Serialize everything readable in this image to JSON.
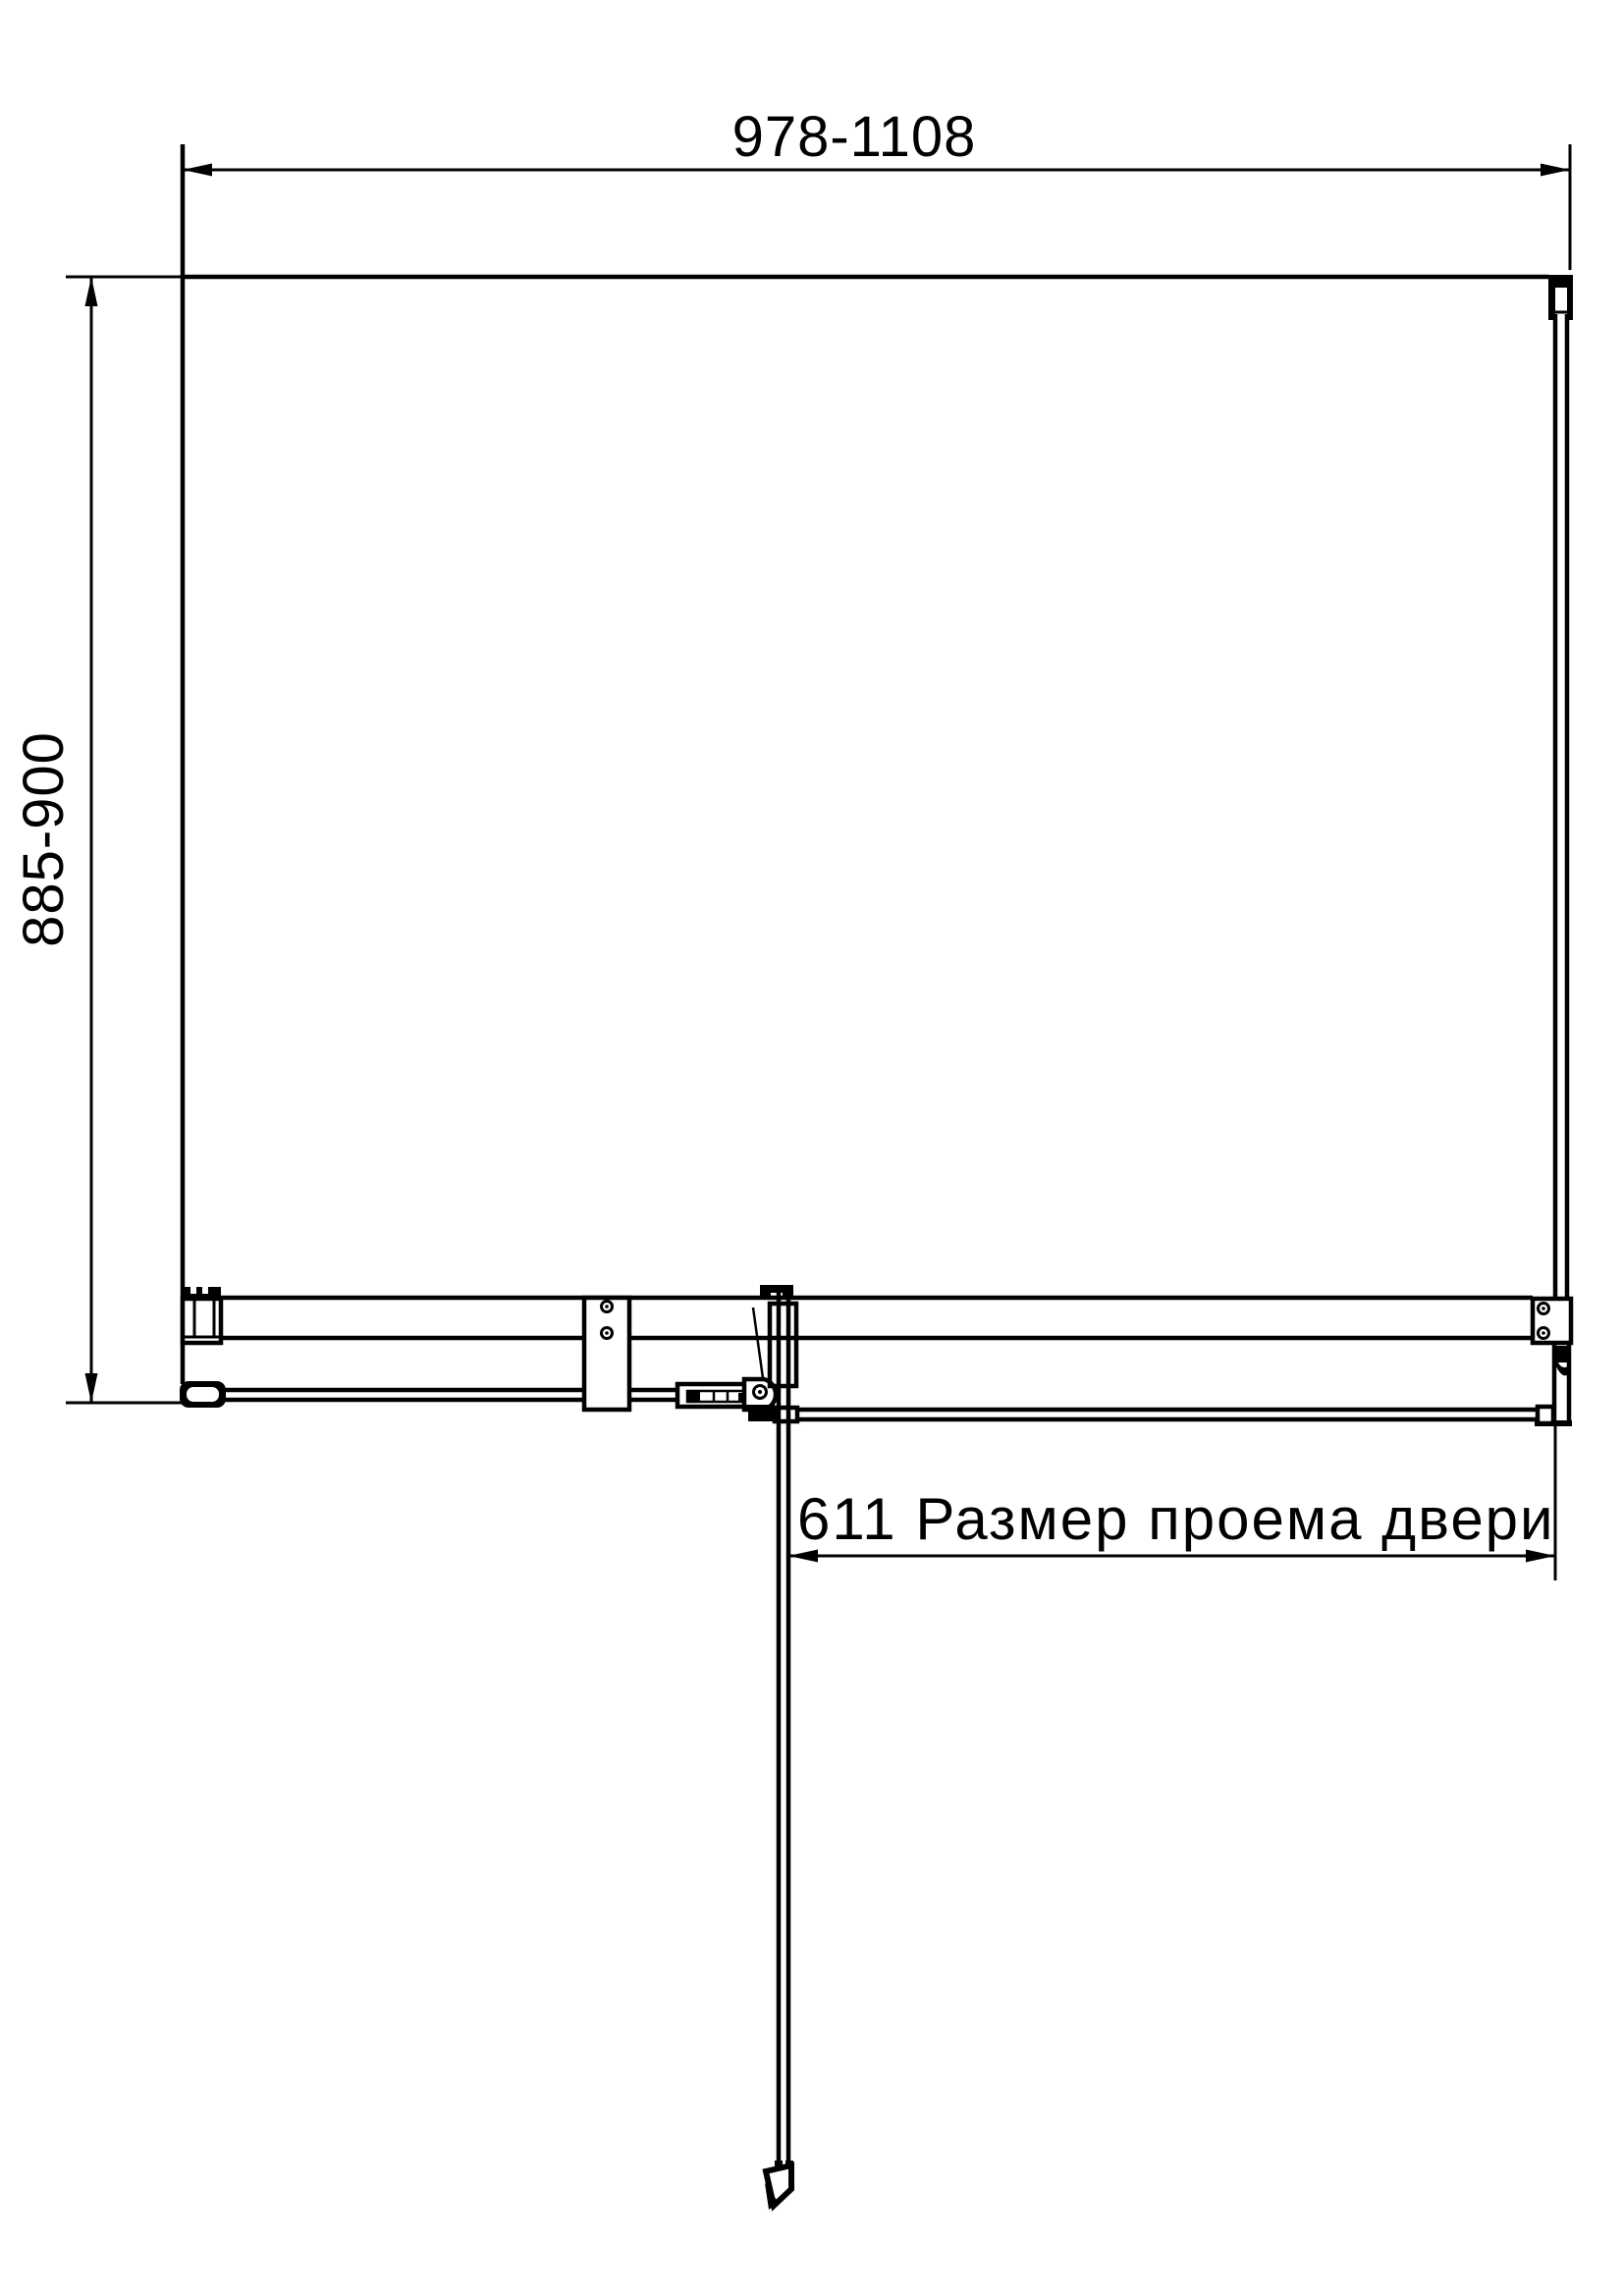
{
  "drawing": {
    "title": "Shower enclosure technical drawing (plan view)",
    "dimensions": {
      "width_range": {
        "label": "978-1108"
      },
      "depth_range": {
        "label": "885-900"
      },
      "door_opening": {
        "label": "611 Размер проема двери"
      }
    },
    "colors": {
      "line": "#000000",
      "background": "#ffffff"
    }
  }
}
